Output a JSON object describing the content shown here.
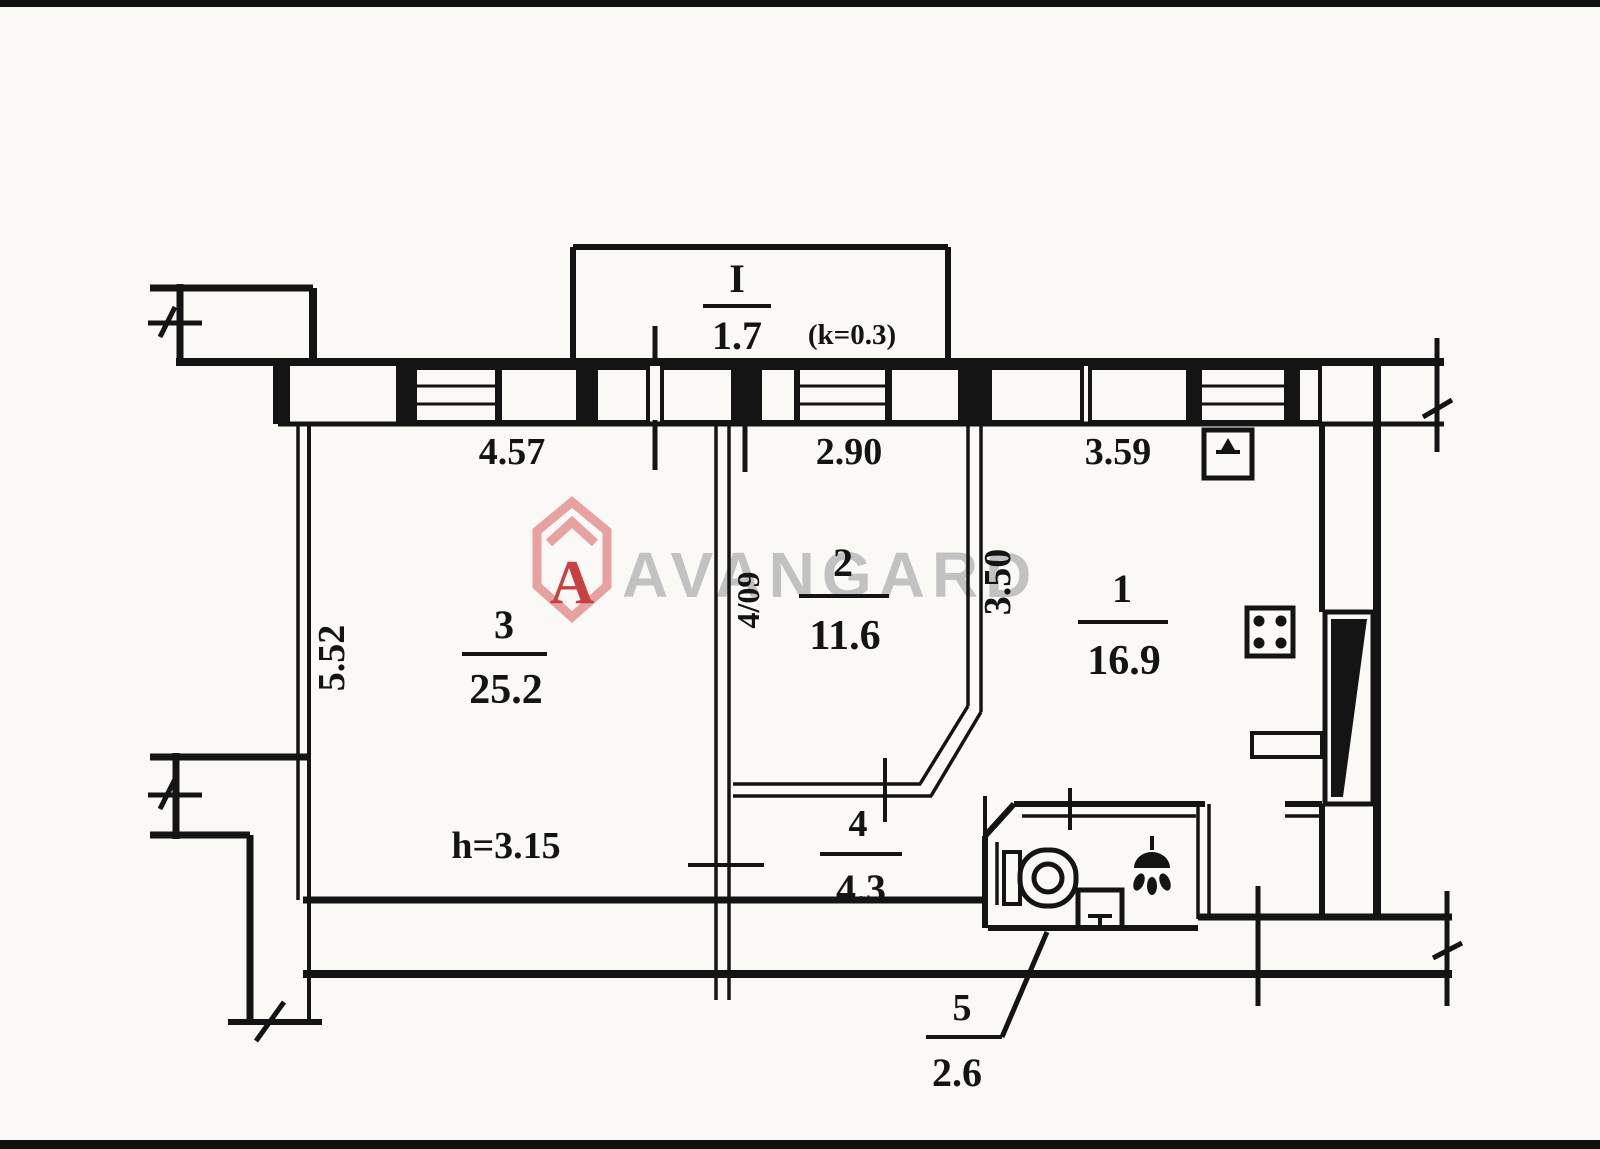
{
  "watermark": {
    "brand": "AVANGARD",
    "logo_letter": "A",
    "text_color": "#b9b9b9",
    "logo_outline_color": "#e7a1a1",
    "logo_letter_color": "#c94040"
  },
  "plan": {
    "balcony": {
      "number": "I",
      "area": "1.7",
      "coefficient": "(k=0.3)"
    },
    "rooms": [
      {
        "number": "1",
        "area": "16.9"
      },
      {
        "number": "2",
        "area": "11.6"
      },
      {
        "number": "3",
        "area": "25.2"
      },
      {
        "number": "4",
        "area": "4.3"
      },
      {
        "number": "5",
        "area": "2.6"
      }
    ],
    "dimensions": {
      "top_left": "4.57",
      "top_middle": "2.90",
      "top_right": "3.59",
      "left_side": "5.52",
      "inner_vertical": "3.50"
    },
    "ceiling_height": "h=3.15",
    "registration": "4/09",
    "ink_color": "#141414"
  }
}
